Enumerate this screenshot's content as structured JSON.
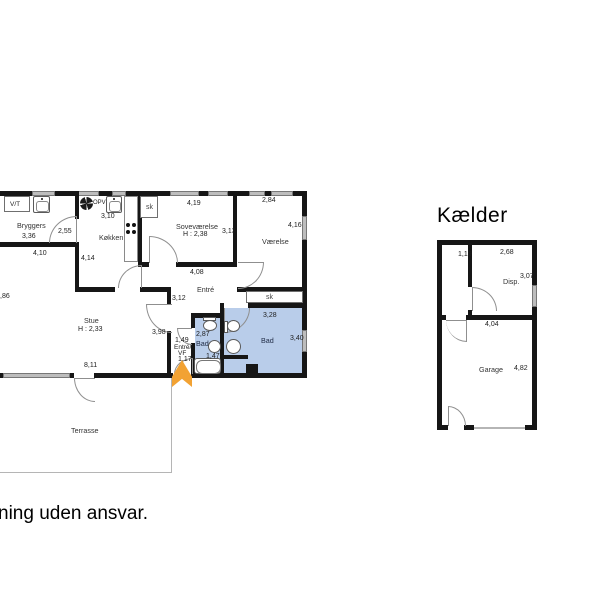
{
  "disclaimer_text": "ning uden ansvar.",
  "colors": {
    "bath_fill": "#b9cdea",
    "arrow": "#f2a233",
    "wall": "#161616",
    "window": "#bdbdbd"
  },
  "ground_floor": {
    "bryggers": {
      "name": "Bryggers",
      "width": "3,36",
      "door": "2,55",
      "outer": "4,10",
      "vt": "V/T"
    },
    "kokken": {
      "name": "Køkken",
      "width": "3,10",
      "depth": "4,14",
      "opv": "OPV"
    },
    "sk_sove": "sk",
    "sovevaerelse": {
      "name": "Soveværelse",
      "ceiling": "H : 2,38",
      "width": "4,19",
      "depth": "3,13",
      "bottom": "4,08"
    },
    "vaerelse": {
      "name": "Værelse",
      "width": "2,84",
      "depth": "4,16"
    },
    "entre": {
      "name": "Entré",
      "width": "3,12"
    },
    "sk_bad": "sk",
    "bad_large": {
      "name": "Bad",
      "width": "3,28",
      "depth": "3,40"
    },
    "bad_small": {
      "name": "Bad",
      "width": "2,87",
      "width2": "1,47"
    },
    "vf": {
      "m1": "1,49",
      "l1": "Entré/",
      "l2": "VF",
      "m2": "1,17"
    },
    "stue": {
      "name": "Stue",
      "ceiling": "H : 2,33",
      "bottom": "8,11",
      "right": "3,98",
      "left_cut": ",86"
    },
    "terrasse": {
      "name": "Terrasse"
    }
  },
  "basement": {
    "title": "Kælder",
    "hall_width": "1,19",
    "disp": {
      "name": "Disp.",
      "width": "2,68",
      "depth": "3,07"
    },
    "garage": {
      "name": "Garage",
      "width": "4,04",
      "depth": "4,82"
    }
  }
}
